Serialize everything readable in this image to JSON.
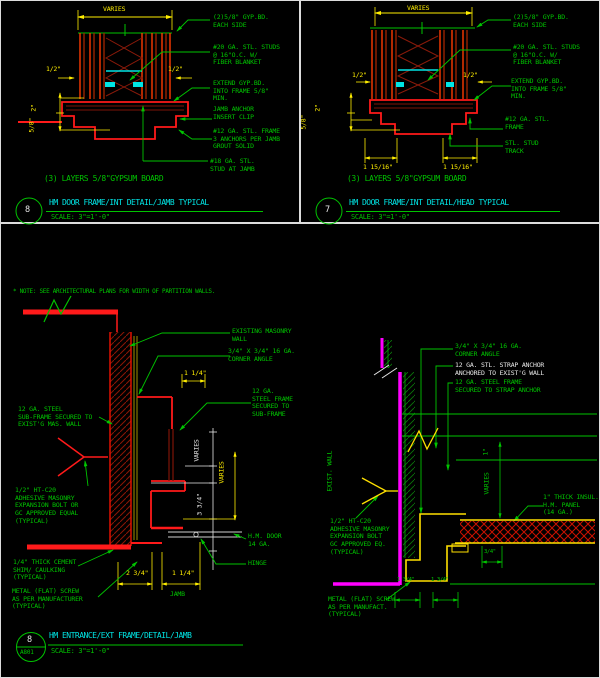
{
  "colors": {
    "background": "#000000",
    "annotation_green": "#00c400",
    "dim_yellow": "#ffee00",
    "bright_red": "#ff1a1a",
    "dark_red": "#7e1408",
    "cyan": "#00e5e5",
    "magenta": "#ff00ff",
    "white": "#e8e8e8"
  },
  "top_left": {
    "dim_varies": "VARIES",
    "dim_half_left": "1/2\"",
    "dim_half_right": "1/2\"",
    "dim_two": "2\"",
    "dim_five_eighths": "5/8\"",
    "ann_gyp": "(2)5/8\" GYP.BD.\nEACH SIDE",
    "ann_studs": "#20 GA. STL. STUDS\n@ 16\"O.C. W/\nFIBER BLANKET",
    "ann_extend": "EXTEND GYP.BD.\nINTO FRAME 5/8\"\nMIN.",
    "ann_jamb_anchor": "JAMB ANCHOR\nINSERT CLIP",
    "ann_frame": "#12 GA. STL. FRAME\n3 ANCHORS PER JAMB\nGROUT SOLID",
    "ann_stud_jamb": "#18 GA. STL.\nSTUD AT JAMB",
    "caption": "(3) LAYERS 5/8\"GYPSUM BOARD",
    "bubble_number": "8",
    "title": "HM DOOR FRAME/INT DETAIL/JAMB TYPICAL",
    "scale": "SCALE: 3\"=1'-0\""
  },
  "top_right": {
    "dim_varies": "VARIES",
    "dim_half_left": "1/2\"",
    "dim_half_right": "1/2\"",
    "dim_two": "2\"",
    "dim_five_eighths": "5/8\"",
    "ann_gyp": "(2)5/8\" GYP.BD.\nEACH SIDE",
    "ann_studs": "#20 GA. STL. STUDS\n@ 16\"O.C. W/\nFIBER BLANKET",
    "ann_extend": "EXTEND GYP.BD.\nINTO FRAME 5/8\"\nMIN.",
    "ann_frame": "#12 GA. STL.\nFRAME",
    "ann_track": "STL. STUD\nTRACK",
    "dim_1_15_16_left": "1 15/16\"",
    "dim_1_15_16_right": "1 15/16\"",
    "caption": "(3) LAYERS 5/8\"GYPSUM BOARD",
    "bubble_number": "7",
    "title": "HM DOOR FRAME/INT DETAIL/HEAD TYPICAL",
    "scale": "SCALE: 3\"=1'-0\""
  },
  "bottom_left": {
    "note": "* NOTE: SEE ARCHITECTURAL PLANS FOR WIDTH OF PARTITION WALLS.",
    "ann_existing_wall": "EXISTING MASONRY\nWALL",
    "ann_corner_angle": "3/4\" X 3/4\" 16 GA.\nCORNER ANGLE",
    "dim_1_14_top": "1 1/4\"",
    "ann_steel_frame": "12 GA.\nSTEEL FRAME\nSECURED TO\nSUB-FRAME",
    "ann_subframe": "12 GA. STEEL\nSUB-FRAME SECURED TO\nEXIST'G MAS. WALL",
    "ann_bolt": "1/2\" HT-C20\nADHESIVE MASONRY\nEXPANSION BOLT OR\nGC APPROVED EQUAL\n(TYPICAL)",
    "ann_shim": "1/4\" THICK CEMENT\nSHIM/ CAULKING\n(TYPICAL)",
    "ann_screw": "METAL (FLAT) SCREW\nAS PER MANUFACTURER\n(TYPICAL)",
    "ann_door": "H.M. DOOR\n14 GA.",
    "ann_hinge": "HINGE",
    "dim_varies_1": "VARIES",
    "dim_3_34": "3 3/4\"",
    "dim_varies_2": "VARIES",
    "dim_2_34": "2 3/4\"",
    "dim_1_14_bottom": "1 1/4\"",
    "label_jamb": "JAMB",
    "bubble_number": "8",
    "bubble_sheet": "A801",
    "title": "HM ENTRANCE/EXT FRAME/DETAIL/JAMB",
    "scale": "SCALE: 3\"=1'-0\""
  },
  "bottom_right": {
    "ann_corner_angle": "3/4\" X 3/4\" 16 GA.\nCORNER ANGLE",
    "ann_strap_anchor": "12 GA. STL. STRAP ANCHOR\nANCHORED TO EXIST'G WALL",
    "ann_steel_frame": "12 GA. STEEL FRAME\nSECURED TO STRAP ANCHOR",
    "label_exist_wall": "EXIST. WALL",
    "ann_panel": "1\" THICK INSUL.\nH.M. PANEL\n(14 GA.)",
    "ann_bolt": "1/2\" HT-C20\nADHESIVE MASONRY\nEXPANSION BOLT\nGC APPROVED EQ.\n(TYPICAL)",
    "ann_screw": "METAL (FLAT) SCREW\nAS PER MANUFACT.\n(TYPICAL)",
    "dim_one": "1\"",
    "dim_varies": "VARIES",
    "dim_34": "3/4\"",
    "dim_1_34_a": "1 3/4\"",
    "dim_1_34_b": "1 3/4\""
  }
}
